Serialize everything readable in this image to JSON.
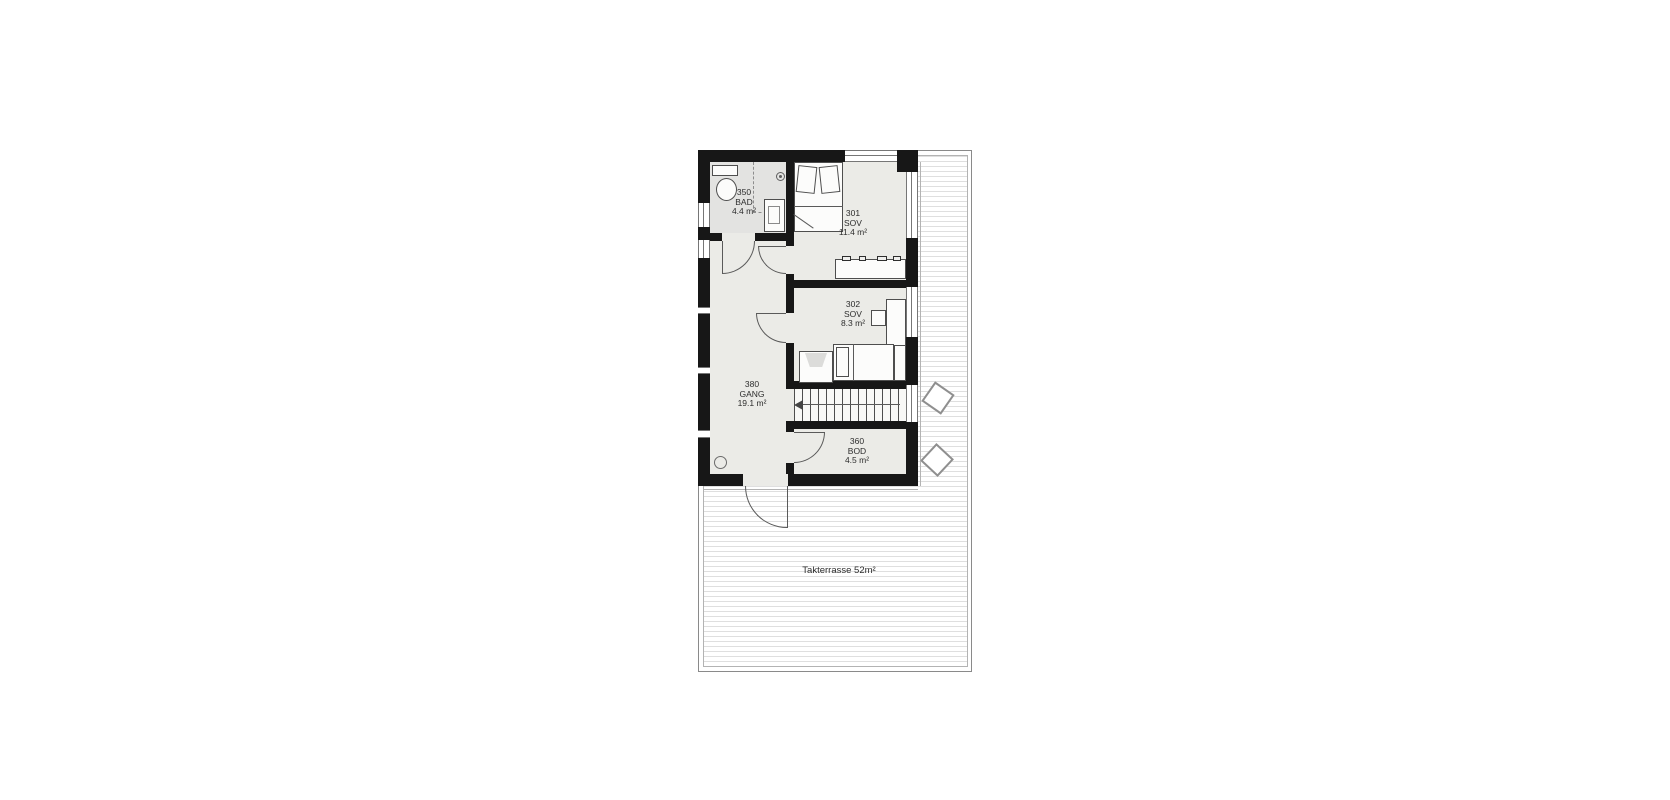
{
  "plan": {
    "title": "floor plan - upper level with roof terrace",
    "rooms": [
      {
        "number": "350",
        "name": "BAD",
        "area": "4.4 m²"
      },
      {
        "number": "301",
        "name": "SOV",
        "area": "11.4 m²"
      },
      {
        "number": "302",
        "name": "SOV",
        "area": "8.3 m²"
      },
      {
        "number": "380",
        "name": "GANG",
        "area": "19.1 m²"
      },
      {
        "number": "360",
        "name": "BOD",
        "area": "4.5 m²"
      }
    ],
    "terrace_label": "Takterrasse 52m²",
    "colors": {
      "wall": "#171717",
      "room_fill": "#ebebe7",
      "bath_fill": "#e3e3e1",
      "deck_line": "#dfdfdf",
      "border_line": "#8a8a8a",
      "text": "#2d2d2d"
    }
  }
}
